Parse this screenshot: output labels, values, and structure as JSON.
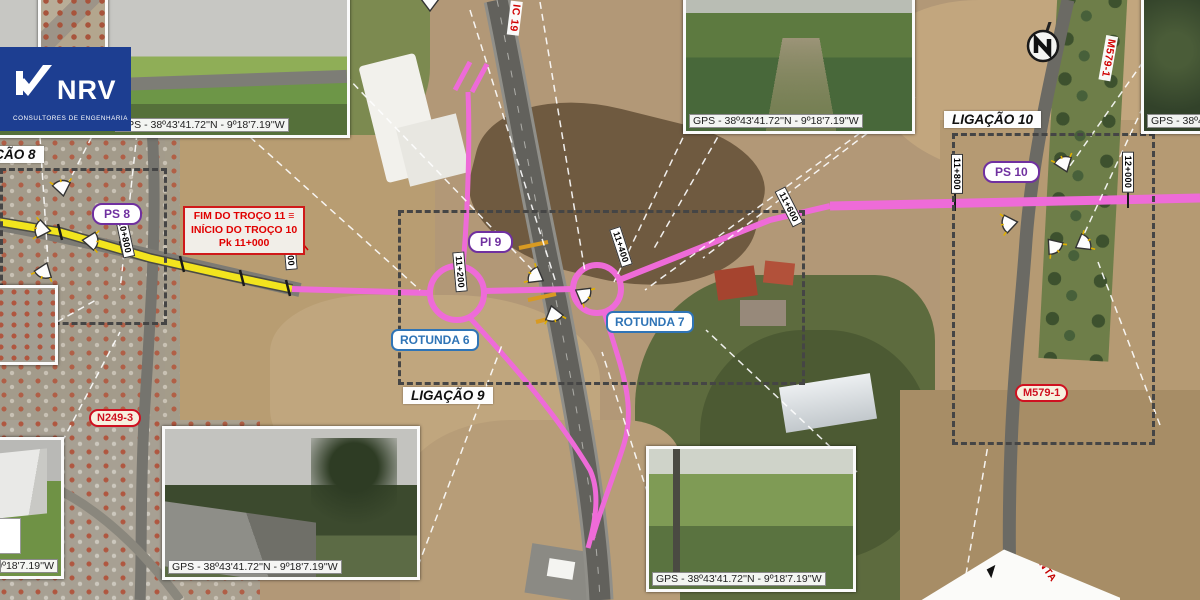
{
  "brand": {
    "name": "NRV",
    "tagline": "CONSULTORES DE ENGENHARIA"
  },
  "gps_caption": "GPS - 38º43'41.72''N - 9º18'7.19''W",
  "labels": {
    "ligacao_8": "LIGAÇÃO 8",
    "ligacao_9": "LIGAÇÃO 9",
    "ligacao_10": "LIGAÇÃO 10",
    "ps_8": "PS 8",
    "pi_9": "PI 9",
    "ps_10": "PS 10",
    "rotunda_6": "ROTUNDA 6",
    "rotunda_7": "ROTUNDA 7",
    "road_n249": "N249-3",
    "road_m579": "M579-1",
    "road_m579_top": "M579-1",
    "road_ic19": "IC 19",
    "planta": "PLANTA",
    "north": "N"
  },
  "annotation": {
    "line1": "FIM DO TROÇO 11 ≡",
    "line2": "INÍCIO DO TROÇO 10",
    "line3": "Pk 11+000"
  },
  "chainage_markers": [
    {
      "label": "10+800",
      "x": 125,
      "y": 237,
      "rot": 78
    },
    {
      "label": "11+000",
      "x": 290,
      "y": 250,
      "rot": 85
    },
    {
      "label": "11+200",
      "x": 460,
      "y": 272,
      "rot": 85
    },
    {
      "label": "11+400",
      "x": 621,
      "y": 247,
      "rot": 72
    },
    {
      "label": "11+600",
      "x": 789,
      "y": 207,
      "rot": 63
    },
    {
      "label": "11+800",
      "x": 957,
      "y": 174,
      "rot": 90
    },
    {
      "label": "12+000",
      "x": 1128,
      "y": 172,
      "rot": 90
    }
  ],
  "camera_markers": [
    {
      "x": 63,
      "y": 193,
      "rot": -10
    },
    {
      "x": 48,
      "y": 230,
      "rot": -80
    },
    {
      "x": 46,
      "y": 265,
      "rot": 200
    },
    {
      "x": 85,
      "y": 240,
      "rot": 95
    },
    {
      "x": 541,
      "y": 279,
      "rot": -60
    },
    {
      "x": 578,
      "y": 291,
      "rot": 120
    },
    {
      "x": 552,
      "y": 308,
      "rot": 165
    },
    {
      "x": 430,
      "y": 8,
      "rot": 0
    },
    {
      "x": 1066,
      "y": 169,
      "rot": -20
    },
    {
      "x": 1015,
      "y": 222,
      "rot": -100
    },
    {
      "x": 1050,
      "y": 241,
      "rot": 140
    },
    {
      "x": 1078,
      "y": 246,
      "rot": 60
    }
  ],
  "leader_lines": [
    [
      130,
      62,
      63,
      193
    ],
    [
      40,
      137,
      48,
      262
    ],
    [
      137,
      133,
      120,
      290
    ],
    [
      250,
      137,
      420,
      290
    ],
    [
      345,
      75,
      541,
      279
    ],
    [
      470,
      10,
      556,
      283
    ],
    [
      540,
      2,
      585,
      272
    ],
    [
      688,
      127,
      614,
      282
    ],
    [
      860,
      133,
      645,
      290
    ],
    [
      915,
      97,
      703,
      258
    ],
    [
      795,
      2,
      652,
      252
    ],
    [
      1143,
      62,
      1067,
      170
    ],
    [
      1143,
      107,
      1079,
      245
    ],
    [
      418,
      566,
      502,
      345
    ],
    [
      655,
      516,
      602,
      352
    ],
    [
      857,
      472,
      706,
      330
    ],
    [
      62,
      442,
      120,
      332
    ],
    [
      57,
      322,
      96,
      300
    ],
    [
      962,
      598,
      988,
      445
    ],
    [
      1160,
      425,
      1098,
      262
    ]
  ],
  "colors": {
    "alignment_pink": "#ee6bd8",
    "existing_yellow": "#f2e41e",
    "study_area_dash": "#454545",
    "brand_blue": "#1d3e91",
    "label_purple": "#7030a0",
    "label_blue": "#2f74b6",
    "road_red": "#d00000"
  }
}
